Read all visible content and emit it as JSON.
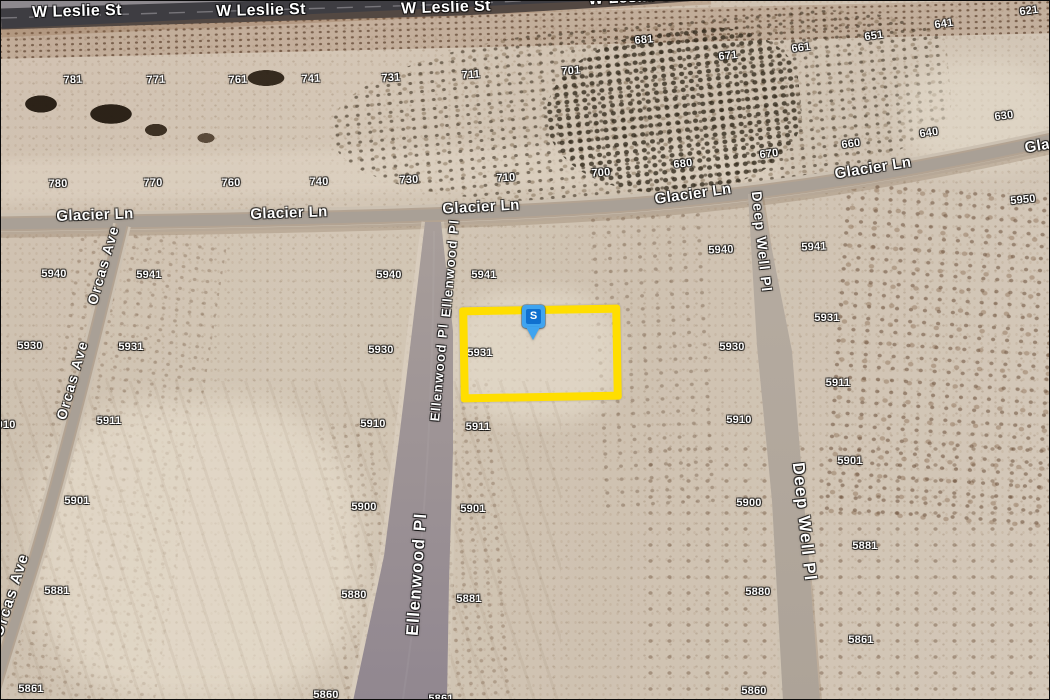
{
  "colors": {
    "parcel_highlight": "#FFDE00",
    "marker_blue": "#3FA4F0",
    "marker_inner_blue": "#1070CF",
    "road_asphalt": "#3E3D42",
    "road_dirt": "#A9A096",
    "label_text": "#FFFFFF"
  },
  "map_view": {
    "imagery": "satellite desert parcels",
    "marker": {
      "label": "S",
      "x": 521,
      "y": 304
    },
    "highlighted_parcel": {
      "x": 459,
      "y": 305,
      "w": 145,
      "h": 79
    },
    "street_labels": [
      {
        "text": "W Leslie St",
        "x": 76,
        "y": 11,
        "rot": -1.5,
        "size": 16
      },
      {
        "text": "W Leslie St",
        "x": 260,
        "y": 10,
        "rot": -1.5,
        "size": 16
      },
      {
        "text": "W Leslie St",
        "x": 445,
        "y": 7,
        "rot": -2,
        "size": 16
      },
      {
        "text": "W Leslie St",
        "x": 632,
        "y": -3,
        "rot": -3,
        "size": 16
      },
      {
        "text": "Glacier Ln",
        "x": 94,
        "y": 214,
        "rot": -2,
        "size": 15
      },
      {
        "text": "Glacier Ln",
        "x": 288,
        "y": 212,
        "rot": -2,
        "size": 15
      },
      {
        "text": "Glacier Ln",
        "x": 480,
        "y": 206,
        "rot": -3,
        "size": 15
      },
      {
        "text": "Glacier Ln",
        "x": 692,
        "y": 193,
        "rot": -8,
        "size": 15
      },
      {
        "text": "Glacier Ln",
        "x": 872,
        "y": 167,
        "rot": -9,
        "size": 15
      },
      {
        "text": "Glacier Ln",
        "x": 1062,
        "y": 141,
        "rot": -9,
        "size": 15
      },
      {
        "text": "Orcas Ave",
        "x": 102,
        "y": 264,
        "rot": -74,
        "size": 14
      },
      {
        "text": "Orcas Ave",
        "x": 71,
        "y": 379,
        "rot": -74,
        "size": 14
      },
      {
        "text": "Orcas Ave",
        "x": 10,
        "y": 594,
        "rot": -72,
        "size": 15
      },
      {
        "text": "Ellenwood Pl",
        "x": 449,
        "y": 267,
        "rot": -85,
        "size": 13
      },
      {
        "text": "Ellenwood Pl",
        "x": 438,
        "y": 371,
        "rot": -85,
        "size": 13
      },
      {
        "text": "Ellenwood Pl",
        "x": 416,
        "y": 573,
        "rot": -86,
        "size": 17
      },
      {
        "text": "Deep Well Pl",
        "x": 761,
        "y": 241,
        "rot": 84,
        "size": 14
      },
      {
        "text": "Deep Well Pl",
        "x": 803,
        "y": 521,
        "rot": 84,
        "size": 17
      }
    ],
    "parcel_labels": [
      {
        "text": "781",
        "x": 72,
        "y": 79,
        "rot": -2
      },
      {
        "text": "771",
        "x": 155,
        "y": 79,
        "rot": -2
      },
      {
        "text": "761",
        "x": 237,
        "y": 79,
        "rot": -2
      },
      {
        "text": "741",
        "x": 310,
        "y": 78,
        "rot": -2
      },
      {
        "text": "731",
        "x": 390,
        "y": 77,
        "rot": -3
      },
      {
        "text": "711",
        "x": 470,
        "y": 74,
        "rot": -4
      },
      {
        "text": "701",
        "x": 570,
        "y": 70,
        "rot": -4
      },
      {
        "text": "681",
        "x": 643,
        "y": 39,
        "rot": -5
      },
      {
        "text": "671",
        "x": 727,
        "y": 55,
        "rot": -6
      },
      {
        "text": "661",
        "x": 800,
        "y": 47,
        "rot": -7
      },
      {
        "text": "651",
        "x": 873,
        "y": 35,
        "rot": -8
      },
      {
        "text": "641",
        "x": 943,
        "y": 23,
        "rot": -8
      },
      {
        "text": "621",
        "x": 1028,
        "y": 10,
        "rot": -8
      },
      {
        "text": "630",
        "x": 1003,
        "y": 115,
        "rot": -7
      },
      {
        "text": "640",
        "x": 928,
        "y": 132,
        "rot": -8
      },
      {
        "text": "660",
        "x": 850,
        "y": 143,
        "rot": -8
      },
      {
        "text": "670",
        "x": 768,
        "y": 153,
        "rot": -7
      },
      {
        "text": "680",
        "x": 682,
        "y": 163,
        "rot": -6
      },
      {
        "text": "700",
        "x": 600,
        "y": 172,
        "rot": -4
      },
      {
        "text": "710",
        "x": 505,
        "y": 177,
        "rot": -3
      },
      {
        "text": "730",
        "x": 408,
        "y": 179,
        "rot": -2
      },
      {
        "text": "740",
        "x": 318,
        "y": 181,
        "rot": -1
      },
      {
        "text": "760",
        "x": 230,
        "y": 182,
        "rot": -1
      },
      {
        "text": "770",
        "x": 152,
        "y": 182,
        "rot": -1
      },
      {
        "text": "780",
        "x": 57,
        "y": 183,
        "rot": -1
      },
      {
        "text": "5950",
        "x": 1022,
        "y": 199,
        "rot": -6
      },
      {
        "text": "5940",
        "x": 53,
        "y": 273,
        "rot": 0
      },
      {
        "text": "5941",
        "x": 148,
        "y": 274,
        "rot": 0
      },
      {
        "text": "5930",
        "x": 29,
        "y": 345,
        "rot": 0
      },
      {
        "text": "5931",
        "x": 130,
        "y": 346,
        "rot": 0
      },
      {
        "text": "5911",
        "x": 108,
        "y": 420,
        "rot": 0
      },
      {
        "text": "5910",
        "x": 2,
        "y": 424,
        "rot": 0
      },
      {
        "text": "5940",
        "x": 388,
        "y": 274,
        "rot": 0
      },
      {
        "text": "5941",
        "x": 483,
        "y": 274,
        "rot": 0
      },
      {
        "text": "5930",
        "x": 380,
        "y": 349,
        "rot": 0
      },
      {
        "text": "5931",
        "x": 479,
        "y": 352,
        "rot": 0
      },
      {
        "text": "5910",
        "x": 372,
        "y": 423,
        "rot": 0
      },
      {
        "text": "5911",
        "x": 477,
        "y": 426,
        "rot": 0
      },
      {
        "text": "5900",
        "x": 363,
        "y": 506,
        "rot": 0
      },
      {
        "text": "5901",
        "x": 472,
        "y": 508,
        "rot": 0
      },
      {
        "text": "5880",
        "x": 353,
        "y": 594,
        "rot": 0
      },
      {
        "text": "5881",
        "x": 468,
        "y": 598,
        "rot": 0
      },
      {
        "text": "5860",
        "x": 325,
        "y": 694,
        "rot": 0
      },
      {
        "text": "5861",
        "x": 440,
        "y": 698,
        "rot": 0
      },
      {
        "text": "5901",
        "x": 76,
        "y": 500,
        "rot": 0
      },
      {
        "text": "5881",
        "x": 56,
        "y": 590,
        "rot": 0
      },
      {
        "text": "5861",
        "x": 30,
        "y": 688,
        "rot": 0
      },
      {
        "text": "5940",
        "x": 720,
        "y": 249,
        "rot": -2
      },
      {
        "text": "5930",
        "x": 731,
        "y": 346,
        "rot": 0
      },
      {
        "text": "5910",
        "x": 738,
        "y": 419,
        "rot": 0
      },
      {
        "text": "5900",
        "x": 748,
        "y": 502,
        "rot": 0
      },
      {
        "text": "5880",
        "x": 757,
        "y": 591,
        "rot": 0
      },
      {
        "text": "5860",
        "x": 753,
        "y": 690,
        "rot": 0
      },
      {
        "text": "5941",
        "x": 813,
        "y": 246,
        "rot": -2
      },
      {
        "text": "5931",
        "x": 826,
        "y": 317,
        "rot": 0
      },
      {
        "text": "5911",
        "x": 837,
        "y": 382,
        "rot": 0
      },
      {
        "text": "5901",
        "x": 849,
        "y": 460,
        "rot": 0
      },
      {
        "text": "5881",
        "x": 864,
        "y": 545,
        "rot": 0
      },
      {
        "text": "5861",
        "x": 860,
        "y": 639,
        "rot": 0
      }
    ]
  }
}
